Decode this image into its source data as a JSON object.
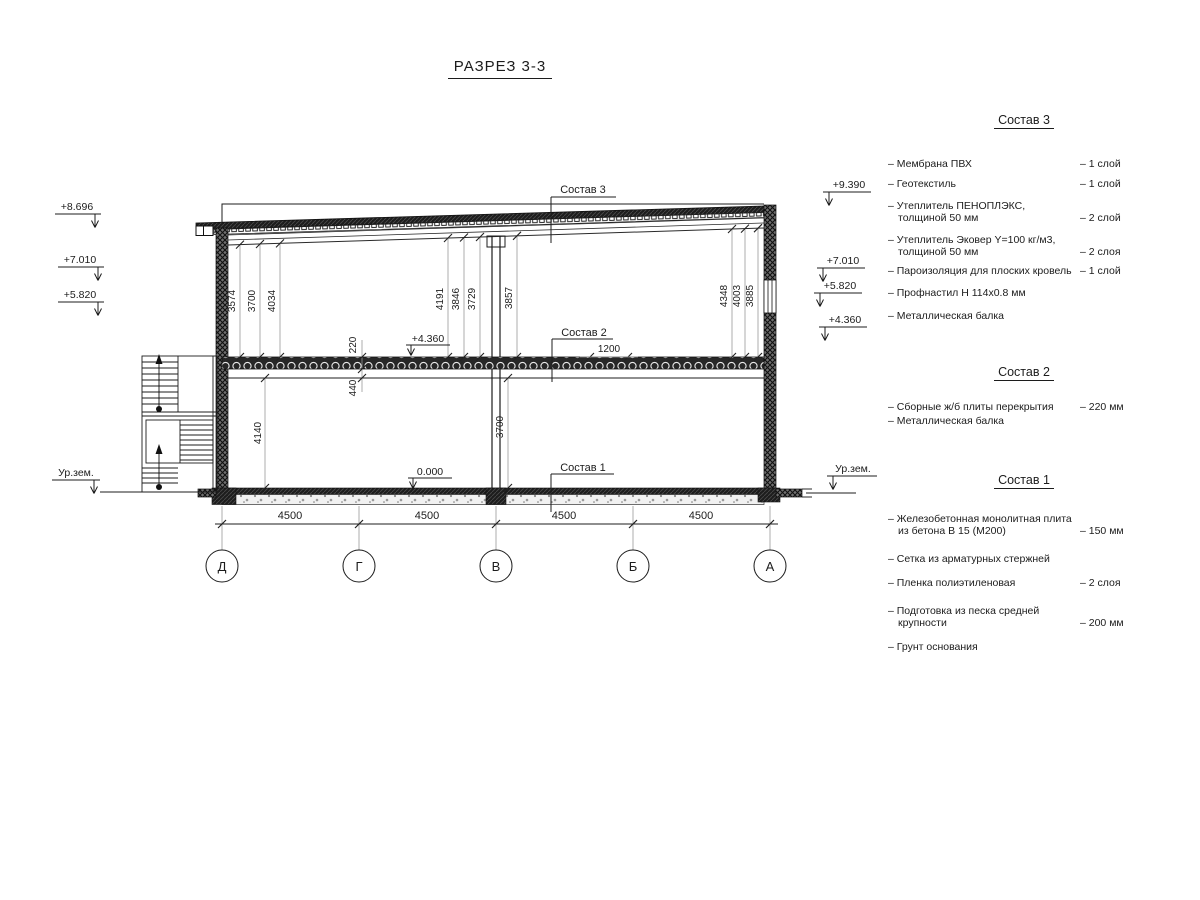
{
  "title": "РАЗРЕЗ 3-3",
  "section": {
    "left_marks": [
      "+8.696",
      "+7.010",
      "+5.820",
      "Ур.зем."
    ],
    "right_marks": [
      "+9.390",
      "+7.010",
      "+5.820",
      "+4.360",
      "Ур.зем."
    ],
    "inner_marks": [
      "+4.360",
      "0.000"
    ],
    "upper_dims": [
      "3574",
      "3700",
      "4034",
      "4191",
      "3846",
      "3729",
      "3857",
      "4348",
      "4003",
      "3885"
    ],
    "lower_dims": {
      "slab": "220",
      "slab_beam": "440",
      "floor1_left": "4140",
      "floor1_right": "3700",
      "plate_width": "1200"
    },
    "axis_labels": [
      "Д",
      "Г",
      "В",
      "Б",
      "А"
    ],
    "axis_spans": [
      "4500",
      "4500",
      "4500",
      "4500"
    ],
    "layer_refs": [
      "Состав 3",
      "Состав 2",
      "Состав 1"
    ]
  },
  "legend": {
    "comp3": {
      "title": "Состав 3",
      "items": [
        {
          "lines": [
            "– Мембрана ПВХ"
          ],
          "qty": "– 1 слой"
        },
        {
          "lines": [
            "– Геотекстиль"
          ],
          "qty": "– 1 слой"
        },
        {
          "lines": [
            "– Утеплитель ПЕНОПЛЭКС,",
            "толщиной 50 мм"
          ],
          "qty": "– 2 слой"
        },
        {
          "lines": [
            "– Утеплитель Эковер Y=100 кг/м3,",
            "толщиной 50 мм"
          ],
          "qty": "– 2 слоя"
        },
        {
          "lines": [
            "– Пароизоляция для плоских кровель"
          ],
          "qty": "– 1 слой"
        },
        {
          "lines": [
            "– Профнастил Н 114х0.8 мм"
          ],
          "qty": ""
        },
        {
          "lines": [
            "– Металлическая балка"
          ],
          "qty": ""
        }
      ]
    },
    "comp2": {
      "title": "Состав 2",
      "items": [
        {
          "lines": [
            "– Сборные ж/б плиты перекрытия"
          ],
          "qty": "– 220 мм"
        },
        {
          "lines": [
            "– Металлическая балка"
          ],
          "qty": ""
        }
      ]
    },
    "comp1": {
      "title": "Состав 1",
      "items": [
        {
          "lines": [
            "– Железобетонная  монолитная плита",
            "из бетона В 15 (М200)"
          ],
          "qty": "– 150 мм"
        },
        {
          "lines": [
            "– Сетка из арматурных стержней"
          ],
          "qty": ""
        },
        {
          "lines": [
            "– Пленка полиэтиленовая"
          ],
          "qty": "–  2 слоя"
        },
        {
          "lines": [
            "– Подготовка из песка средней",
            "крупности"
          ],
          "qty": "– 200 мм"
        },
        {
          "lines": [
            "– Грунт основания"
          ],
          "qty": ""
        }
      ]
    }
  }
}
